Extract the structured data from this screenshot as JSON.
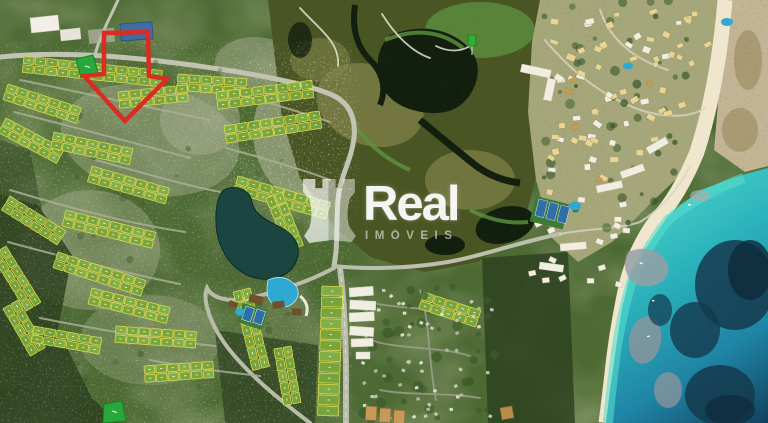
{
  "watermark": {
    "brand": "Real",
    "subtitle": "IMÓVEIS",
    "icon": "rook-chess-piece-icon",
    "color": "#ffffff"
  },
  "annotations": {
    "pointer_arrow": {
      "name": "red-location-arrow",
      "color": "#da2d22"
    },
    "highlighted_lots": {
      "color": "#27a83b",
      "count": 2
    }
  },
  "map": {
    "type": "aerial-satellite-masterplan",
    "regions": [
      "residential-lot-development",
      "central-lake",
      "clubhouse-amenities",
      "mangrove-wetland",
      "resort-village",
      "beach",
      "ocean-lagoon",
      "existing-village",
      "dense-forest",
      "access-roads"
    ]
  },
  "palette": {
    "base_land": "#4d6a33",
    "forest": "#2b401f",
    "scrub": "#adb295",
    "mangrove": "#4a5524",
    "marsh": "#7d8046",
    "mangrove_water": "#131f0e",
    "mangrove_fringe": "#5e9440",
    "resort_ground": "#a5a679",
    "flats": "#c2b494",
    "sand": "#efe6cd",
    "water_shallow": "#4ed7c9",
    "water_mid": "#1f9db4",
    "water_deep": "#12405e",
    "reef_dark": "#15394e",
    "shoal": "#979fa6",
    "road": "#c2c4b2",
    "road_minor": "#a9ae97",
    "lot_fill": "#79a73c",
    "lot_fill2": "#83b146",
    "lot_stroke": "#e3de4e",
    "roof_yellow": "#e9d593",
    "roof_white": "#f2eee2",
    "roof_orange": "#cf9a4e",
    "house": "#e4e1d4",
    "tree": "#3b5a2b",
    "lake": "#1b4540",
    "pool": "#2fa9d2",
    "court": "#2f6fa8",
    "roof_brown": "#6f512e",
    "apartment_white": "#f0ede2",
    "apartment_tan": "#c69a56"
  }
}
